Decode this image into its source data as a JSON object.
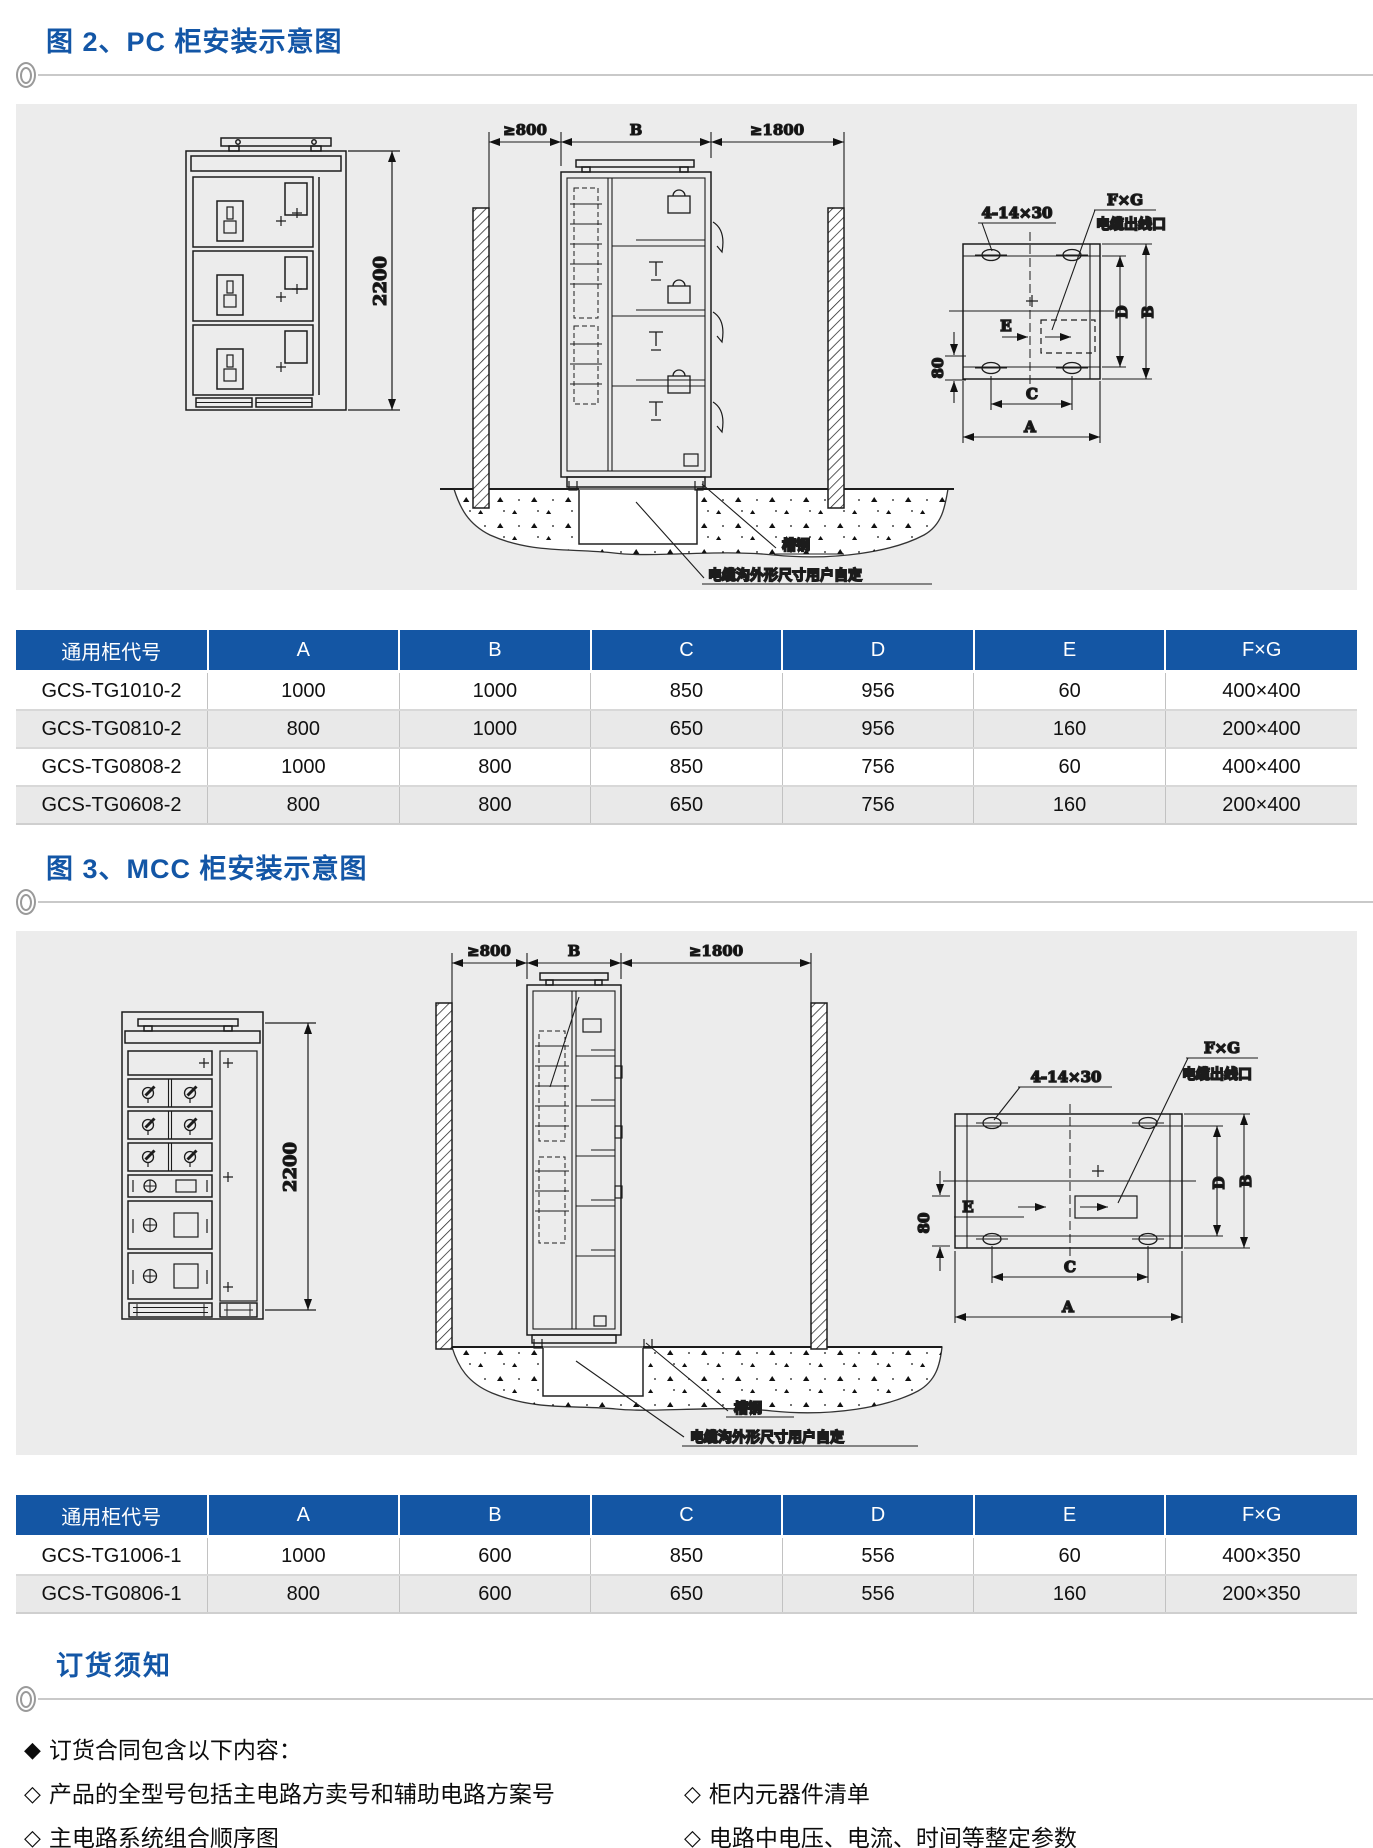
{
  "figure2": {
    "title": "图 2、PC 柜安装示意图",
    "dims": {
      "height": "2200",
      "left_clearance": "≥800",
      "width": "B",
      "right_clearance": "≥1800",
      "holes": "4-14×30",
      "fg": "F×G",
      "outlet": "电缆出线口",
      "e": "E",
      "offset": "80",
      "c": "C",
      "a": "A",
      "d": "D",
      "b": "B",
      "channel": "槽钢",
      "trench": "电缆沟外形尺寸用户自定"
    },
    "table": {
      "headers": [
        "通用柜代号",
        "A",
        "B",
        "C",
        "D",
        "E",
        "F×G"
      ],
      "rows": [
        [
          "GCS-TG1010-2",
          "1000",
          "1000",
          "850",
          "956",
          "60",
          "400×400"
        ],
        [
          "GCS-TG0810-2",
          "800",
          "1000",
          "650",
          "956",
          "160",
          "200×400"
        ],
        [
          "GCS-TG0808-2",
          "1000",
          "800",
          "850",
          "756",
          "60",
          "400×400"
        ],
        [
          "GCS-TG0608-2",
          "800",
          "800",
          "650",
          "756",
          "160",
          "200×400"
        ]
      ]
    }
  },
  "figure3": {
    "title": "图 3、MCC 柜安装示意图",
    "dims": {
      "height": "2200",
      "left_clearance": "≥800",
      "width": "B",
      "right_clearance": "≥1800",
      "holes": "4-14×30",
      "fg": "F×G",
      "outlet": "电缆出线口",
      "e": "E",
      "offset": "80",
      "c": "C",
      "a": "A",
      "d": "D",
      "b": "B",
      "channel": "槽钢",
      "trench": "电缆沟外形尺寸用户自定"
    },
    "table": {
      "headers": [
        "通用柜代号",
        "A",
        "B",
        "C",
        "D",
        "E",
        "F×G"
      ],
      "rows": [
        [
          "GCS-TG1006-1",
          "1000",
          "600",
          "850",
          "556",
          "60",
          "400×350"
        ],
        [
          "GCS-TG0806-1",
          "800",
          "600",
          "650",
          "556",
          "160",
          "200×350"
        ]
      ]
    }
  },
  "ordering": {
    "title": "订货须知",
    "heading_bullet": "◆",
    "heading": "订货合同包含以下内容：",
    "item_bullet": "◇",
    "rows": [
      {
        "left": "产品的全型号包括主电路方卖号和辅助电路方案号",
        "right": "柜内元器件清单"
      },
      {
        "left": "主电路系统组合顺序图",
        "right": "电路中电压、电流、时间等整定参数"
      },
      {
        "left": "辅助电路电气原理图",
        "right": "与产品正常使用不符的其它特殊要求"
      }
    ]
  },
  "colors": {
    "accent": "#1356a6",
    "table_header": "#1456a4",
    "panel_bg": "#ececec",
    "row_alt": "#e9e9e9"
  }
}
